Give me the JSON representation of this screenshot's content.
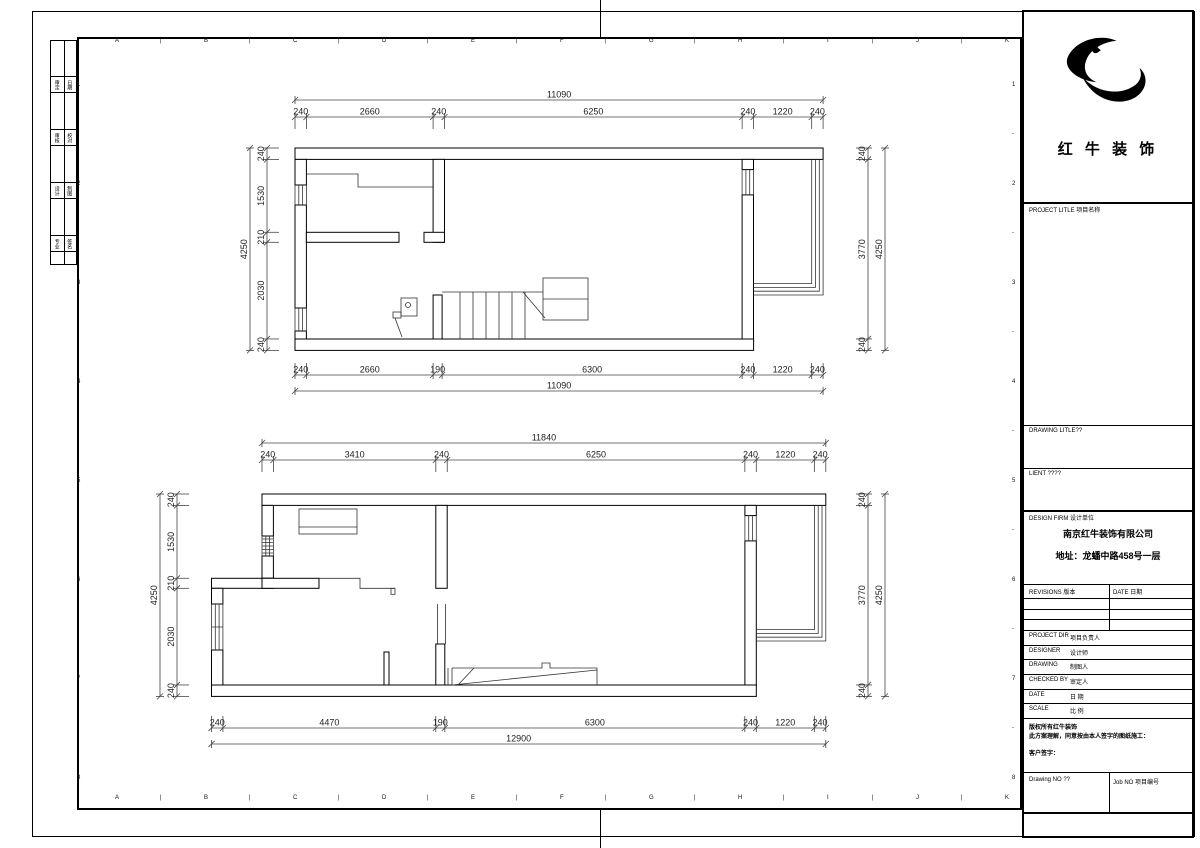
{
  "frame": {
    "col_labels": [
      "A",
      "B",
      "C",
      "D",
      "E",
      "F",
      "G",
      "H",
      "I",
      "J",
      "K"
    ],
    "row_labels": [
      "1",
      "2",
      "3",
      "4",
      "5",
      "6",
      "7",
      "8"
    ],
    "tick": "|",
    "dash": "-"
  },
  "signoff_strip": {
    "rows": [
      {
        "left": "审定",
        "right": "日期"
      },
      {
        "left": "审核",
        "right": "校对"
      },
      {
        "left": "设计",
        "right": "制图"
      },
      {
        "left": "专业",
        "right": "签名"
      }
    ]
  },
  "title_block": {
    "brand": "红 牛 装 饰",
    "project_title_label": "PROJECT LITLE 项目名称",
    "drawing_title_label": "DRAWING LITLE??",
    "client_label": "LIENT ????",
    "design_firm_label": "DESIGN FIRM 设计单位",
    "firm_name": "南京红牛装饰有限公司",
    "firm_address": "地址：龙蟠中路458号一层",
    "revisions_label": "REVISIONS 版本",
    "revisions_date_label": "DATE 日期",
    "fields": [
      {
        "en": "PROJECT DIR",
        "zh": "项目负责人"
      },
      {
        "en": "DESIGNER",
        "zh": "设计师"
      },
      {
        "en": "DRAWING",
        "zh": "制图人"
      },
      {
        "en": "CHECKED BY",
        "zh": "审定人"
      },
      {
        "en": "DATE",
        "zh": "日 期"
      },
      {
        "en": "SCALE",
        "zh": "比 例"
      }
    ],
    "copyright_line1": "版权所有红牛装饰",
    "copyright_line2": "此方案理解，同意按由本人签字的图纸施工：",
    "customer_sign_label": "客户签字：",
    "drawing_no_label": "Drawing NO ??",
    "job_no_label": "Job NO 项目编号"
  },
  "plans": [
    {
      "name": "first-floor-plan",
      "dims_top_overall": "11090",
      "dims_top": [
        "240",
        "2660",
        "240",
        "6250",
        "240",
        "1220",
        "240"
      ],
      "dims_bottom": [
        "240",
        "2660",
        "190",
        "6300",
        "240",
        "1220",
        "240"
      ],
      "dims_bottom_overall": "11090",
      "dims_left": [
        "240",
        "1530",
        "210",
        "2030",
        "240"
      ],
      "dims_left_overall": "4250",
      "dims_right": [
        "240",
        "3770",
        "240"
      ],
      "dims_right_overall": "4250"
    },
    {
      "name": "second-floor-plan",
      "dims_top_overall": "11840",
      "dims_top": [
        "240",
        "3410",
        "240",
        "6250",
        "240",
        "1220",
        "240"
      ],
      "dims_bottom": [
        "240",
        "4470",
        "190",
        "6300",
        "240",
        "1220",
        "240"
      ],
      "dims_bottom_overall": "12900",
      "dims_left": [
        "240",
        "1530",
        "210",
        "2030",
        "240"
      ],
      "dims_left_overall": "4250",
      "dims_right": [
        "240",
        "3770",
        "240"
      ],
      "dims_right_overall": "4250"
    }
  ]
}
